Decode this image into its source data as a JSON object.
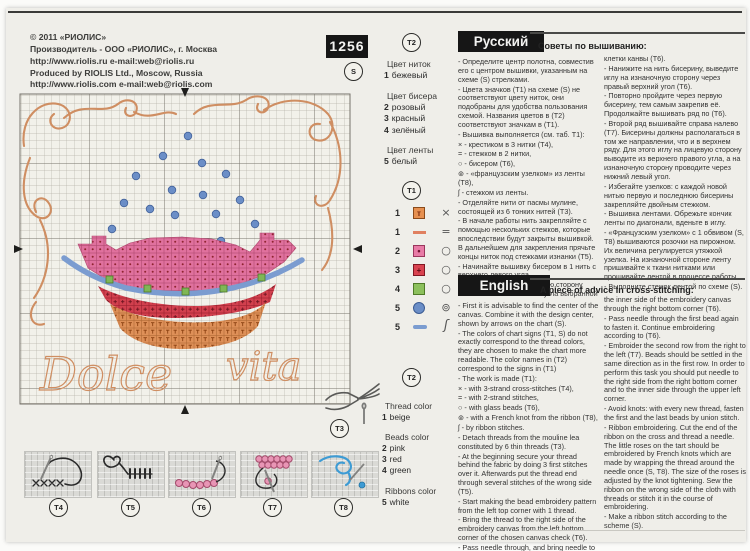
{
  "header": {
    "pattern_number": "1256",
    "chart_badge": "S",
    "publisher_lines": [
      "© 2011 «РИОЛИС»",
      "Производитель - ООО «РИОЛИС», г. Москва",
      "http://www.riolis.ru    e-mail:web@riolis.ru",
      "Produced by RIOLIS Ltd., Moscow, Russia",
      "http://www.riolis.com   e-mail:web@riolis.com"
    ]
  },
  "chart": {
    "script_word_1": "Dolce",
    "script_word_2": "vita",
    "colors": {
      "swirl_backstitch": "#cf8e62",
      "pink_beads": "#e0719e",
      "red_beads": "#d2404e",
      "green_beads": "#7fb756",
      "blue_ribbon": "#7b9cd0",
      "rose_knots": "#6b8ec7",
      "beige_cross": "#de9058"
    }
  },
  "legend_ru": {
    "badge": "T2",
    "lines": [
      {
        "num": "",
        "name": "Цвет ниток",
        "cls": "lg-line lg-title"
      },
      {
        "num": "1",
        "name": "бежевый",
        "cls": "lg-line"
      },
      {
        "num": "",
        "name": "Цвет бисера",
        "cls": "lg-line lg-title"
      },
      {
        "num": "2",
        "name": "розовый",
        "cls": "lg-line"
      },
      {
        "num": "3",
        "name": "красный",
        "cls": "lg-line"
      },
      {
        "num": "4",
        "name": "зелёный",
        "cls": "lg-line"
      },
      {
        "num": "",
        "name": "Цвет ленты",
        "cls": "lg-line lg-title"
      },
      {
        "num": "5",
        "name": "белый",
        "cls": "lg-line"
      }
    ]
  },
  "symbol_table": {
    "badge": "T1",
    "rows": [
      {
        "num": "1",
        "chip": "beige-square-t",
        "chip_char": "т",
        "glyph": "×",
        "glyph_cls": "glyph"
      },
      {
        "num": "1",
        "chip": "orange-dash",
        "chip_char": "",
        "glyph": "=",
        "glyph_cls": "glyph"
      },
      {
        "num": "2",
        "chip": "pink-square-dot",
        "chip_char": "•",
        "glyph": "○",
        "glyph_cls": "glyph"
      },
      {
        "num": "3",
        "chip": "red-square-plus",
        "chip_char": "+",
        "glyph": "○",
        "glyph_cls": "glyph"
      },
      {
        "num": "4",
        "chip": "green-square",
        "chip_char": "",
        "glyph": "○",
        "glyph_cls": "glyph"
      },
      {
        "num": "5",
        "chip": "blue-circle",
        "chip_char": "",
        "glyph": "⊚",
        "glyph_cls": "glyph"
      },
      {
        "num": "5",
        "chip": "blue-dash",
        "chip_char": "",
        "glyph": "ʃ",
        "glyph_cls": "glyph rib"
      }
    ]
  },
  "legend_en": {
    "badge": "T2",
    "lines": [
      {
        "num": "",
        "name": "Thread color",
        "cls": "lg-line lg-title"
      },
      {
        "num": "1",
        "name": "beige",
        "cls": "lg-line"
      },
      {
        "num": "",
        "name": "Beads color",
        "cls": "lg-line lg-title"
      },
      {
        "num": "2",
        "name": "pink",
        "cls": "lg-line"
      },
      {
        "num": "3",
        "name": "red",
        "cls": "lg-line"
      },
      {
        "num": "4",
        "name": "green",
        "cls": "lg-line"
      },
      {
        "num": "",
        "name": "Ribbons color",
        "cls": "lg-line lg-title"
      },
      {
        "num": "5",
        "name": "white",
        "cls": "lg-line"
      }
    ]
  },
  "tools": {
    "pliers_badge": "T3"
  },
  "instructions": {
    "ru": {
      "header": "Русский",
      "tips_title": "Советы по вышиванию:",
      "col1": [
        "- Определите центр полотна, совместив его с центром вышивки, указанным на схеме (S) стрелками.",
        "- Цвета значков (T1) на схеме (S) не соответствуют цвету ниток, они подобраны для удобства пользования схемой. Названия цветов в (T2) соответствуют значкам в (T1).",
        "- Вышивка выполняется (см. таб. T1):",
        "× - крестиком в 3 нитки (T4),",
        "= - стежком в 2 нитки,",
        "○ - бисером (T6),",
        "⊚ - «французским узелком» из ленты (T8),",
        "ʃ - стежком из ленты.",
        "- Отделяйте нити от пасмы мулине, состоящей из 6 тонких нитей (T3).",
        "- В начале работы нить закрепляйте с помощью нескольких стежков, которые впоследствии будут закрыты вышивкой. В дальнейшем для закрепления прячьте концы ниток под стежками изнанки (T5).",
        "- Начинайте вышивку бисером в 1 нить с верхнего левого угла.",
        "- Выведите нить на лицевую сторону канвы из нижнего левого угла выбранной"
      ],
      "col2": [
        "клетки канвы (T6).",
        "- Нанижите на нить бисерину, выведите иглу на изнаночную сторону через правый верхний угол (T6).",
        "- Повторно пройдите через первую бисерину, тем самым закрепив её. Продолжайте вышивать ряд по (T6).",
        "- Второй ряд вышивайте справа налево (T7). Бисерины должны располагаться в том же направлении, что и в верхнем ряду. Для этого иглу на лицевую сторону выводите из верхнего правого угла, а на изнаночную сторону проводите через нижний левый угол.",
        "- Избегайте узелков: с каждой новой нитью первую и последнюю бисерины закрепляйте двойным стежком.",
        "- Вышивка лентами. Обрежьте кончик ленты по диагонали, вденьте в иглу.",
        "- «Французским узелком» с 1 обвивом (S, T8) вышиваются розочки на пирожном. Их величина регулируется утяжкой узелка. На изнаночной стороне ленту пришивайте к ткани нитками или прошивайте лентой в процессе работы.",
        "- Выполните стежок лентой по схеме (S)."
      ]
    },
    "en": {
      "header": "English",
      "tips_title": "A piece of advice in cross-stitching:",
      "col1": [
        "- First it is advisable to find the center of the canvas. Combine it with the design center, shown by arrows on the chart (S).",
        "- The colors of chart signs (T1, S) do not exactly correspond to the thread colors, they are chosen to make the chart more readable. The color names in (T2) correspond to the signs in (T1)",
        "- The work is made (T1):",
        "× - with 3-strand cross-stitches (T4),",
        "= - with 2-strand stitches,",
        "○ - with glass beads (T6),",
        "⊚ - with a French knot from the ribbon (T8),",
        "ʃ - by ribbon stitches.",
        "- Detach threads from the mouline lea constituted by 6 thin threads (T3).",
        "- At the beginning secure your thread behind the fabric by doing 3 first stitches over it. Afterwards put the thread end through several stitches of the wrong side (T5).",
        "- Start making the bead embroidery pattern from the left top corner with 1 thread.",
        "- Bring the thread to the right side of the embroidery canvas from the left bottom corner of the chosen canvas check (T6).",
        "- Pass needle through, and bring needle to"
      ],
      "col2": [
        "the inner side of the embroidery canvas through the right bottom corner (T6).",
        "- Pass needle through the first bead again to fasten it. Continue embroidering according to (T6).",
        "- Embroider the second row from the right to the left (T7). Beads should be settled in the same direction as in the first row. In order to perform this task you should put needle to the right side from the right bottom corner and to the inner side through the upper left corner.",
        "- Avoid knots: with every new thread, fasten the first and the last beads by union stitch.",
        "- Ribbon embroidering. Cut the end of the ribbon on the cross and thread a needle. The little roses on the tart should be embroidered by French knots which are made by wrapping the thread around the needle once (S, T8). The size of the roses is adjusted by the knot tightening. Sew the ribbon on the wrong side of the cloth with threads or stitch it in the course of embroidering.",
        "- Make a ribbon stitch according to the scheme (S)."
      ]
    }
  },
  "technique": {
    "items": [
      {
        "label": "T4",
        "icon": "cross-stitch-diagram"
      },
      {
        "label": "T5",
        "icon": "secure-thread-diagram"
      },
      {
        "label": "T6",
        "icon": "bead-row-diagram"
      },
      {
        "label": "T7",
        "icon": "bead-second-row-diagram"
      },
      {
        "label": "T8",
        "icon": "ribbon-knot-diagram"
      }
    ]
  }
}
